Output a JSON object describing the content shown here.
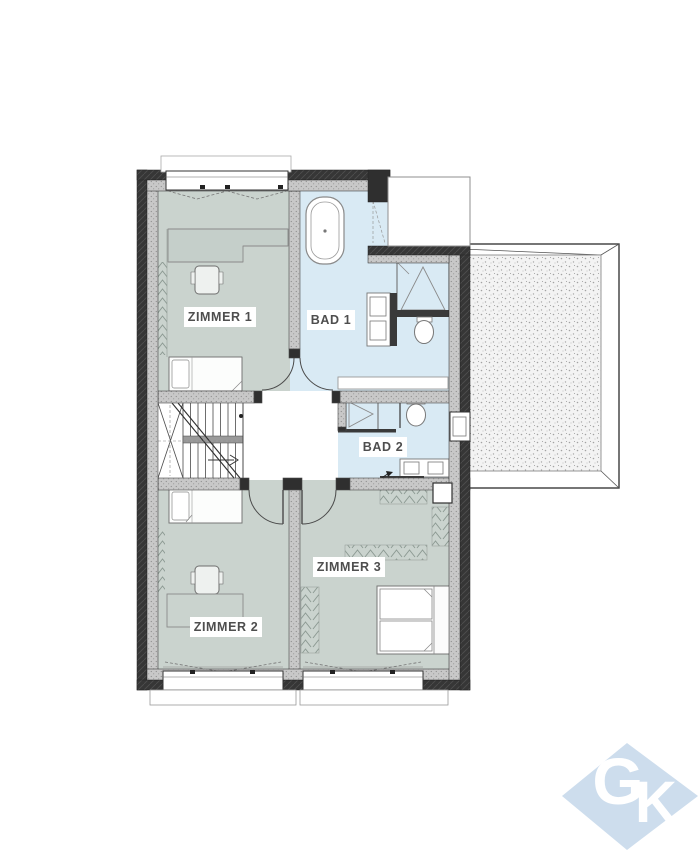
{
  "floorplan": {
    "type": "floor-plan",
    "rooms": [
      {
        "id": "zimmer-1",
        "label": "ZIMMER 1",
        "fill": "#cad3ce"
      },
      {
        "id": "bad-1",
        "label": "BAD 1",
        "fill": "#d9eaf4"
      },
      {
        "id": "bad-2",
        "label": "BAD 2",
        "fill": "#d9eaf4"
      },
      {
        "id": "zimmer-3",
        "label": "ZIMMER 3",
        "fill": "#cad3ce"
      },
      {
        "id": "zimmer-2",
        "label": "ZIMMER 2",
        "fill": "#cad3ce"
      }
    ],
    "colors": {
      "background": "#ffffff",
      "wall_dark": "#353535",
      "wall_light": "#c8c8c8",
      "hall_fill": "#ffffff",
      "label_text": "#4e4e4e",
      "fixture_outline": "#7a7a7a"
    },
    "fixtures": [
      "bathtub",
      "shower",
      "toilet",
      "washbasin",
      "radiator",
      "stairs",
      "single-bed",
      "double-bed",
      "desk",
      "chair",
      "wardrobe",
      "window",
      "door",
      "terrace"
    ]
  },
  "watermark": {
    "letter_g": "G",
    "letter_k": "K",
    "fill": "#cddded",
    "text_color": "#ffffff"
  }
}
